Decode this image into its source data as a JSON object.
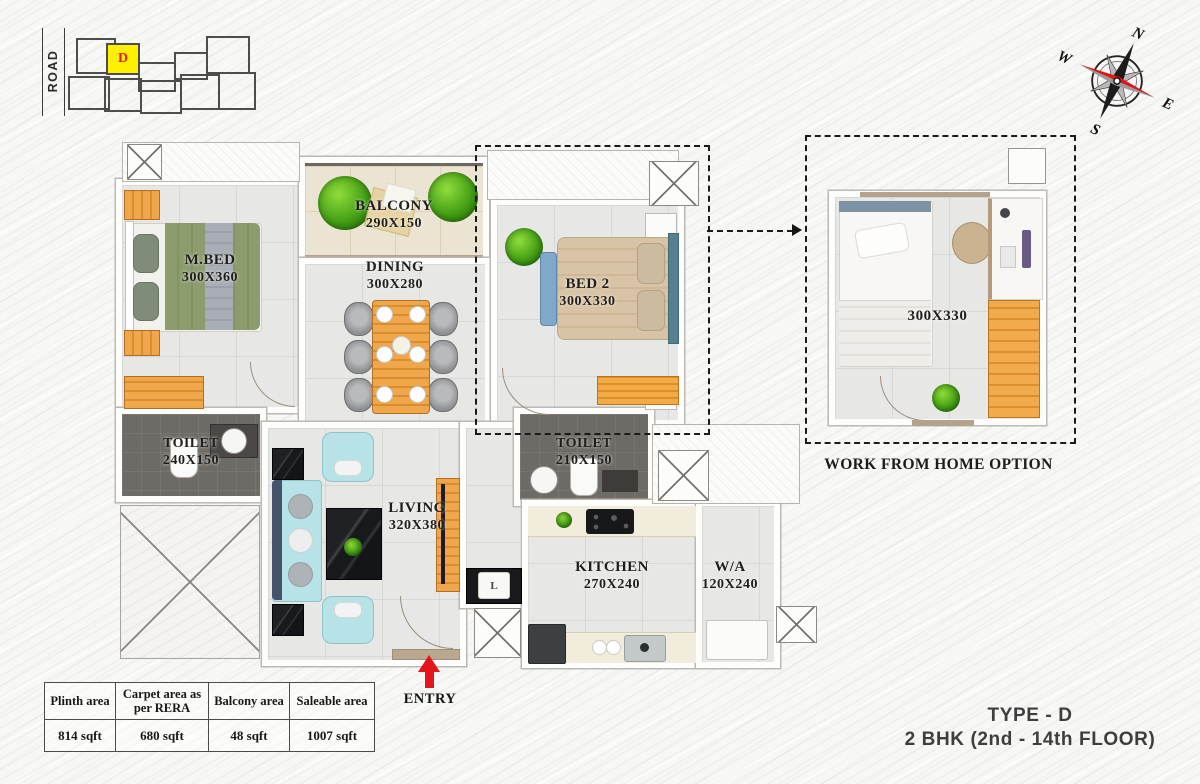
{
  "site_plan": {
    "road": "ROAD",
    "highlighted_unit": "D"
  },
  "compass": {
    "n": "N",
    "e": "E",
    "s": "S",
    "w": "W"
  },
  "plan": {
    "rooms": [
      {
        "id": "mbed",
        "name": "M.BED",
        "dims": "300X360"
      },
      {
        "id": "balcony",
        "name": "BALCONY",
        "dims": "290X150"
      },
      {
        "id": "dining",
        "name": "DINING",
        "dims": "300X280"
      },
      {
        "id": "bed2",
        "name": "BED 2",
        "dims": "300X330"
      },
      {
        "id": "toilet1",
        "name": "TOILET",
        "dims": "240X150"
      },
      {
        "id": "toilet2",
        "name": "TOILET",
        "dims": "210X150"
      },
      {
        "id": "living",
        "name": "LIVING",
        "dims": "320X380"
      },
      {
        "id": "kitchen",
        "name": "KITCHEN",
        "dims": "270X240"
      },
      {
        "id": "wa",
        "name": "W/A",
        "dims": "120X240"
      }
    ],
    "entry_label": "ENTRY",
    "foyer_unit_label": "L"
  },
  "wfh_inset": {
    "dims": "300X330",
    "caption": "WORK FROM HOME OPTION"
  },
  "area_table": {
    "headers": [
      "Plinth area",
      "Carpet area as per RERA",
      "Balcony area",
      "Saleable area"
    ],
    "values": [
      "814 sqft",
      "680 sqft",
      "48 sqft",
      "1007 sqft"
    ]
  },
  "footer": {
    "type": "TYPE - D",
    "unit": "2 BHK (2nd - 14th FLOOR)"
  },
  "colors": {
    "accent_red": "#e2161c",
    "highlight_yellow": "#ffef00",
    "unit_letter_red": "#e1201c",
    "wood_orange": "#e8a143",
    "bed_green": "#8d9c6f",
    "bed2_tan": "#d9c3a6",
    "sofa_blue": "#b7e3e8",
    "dark_toilet_floor": "#6e6a65",
    "marble_black": "#1b1c1e",
    "dash_black": "#1b1b1b",
    "compass_needle_red": "#e0151a"
  }
}
